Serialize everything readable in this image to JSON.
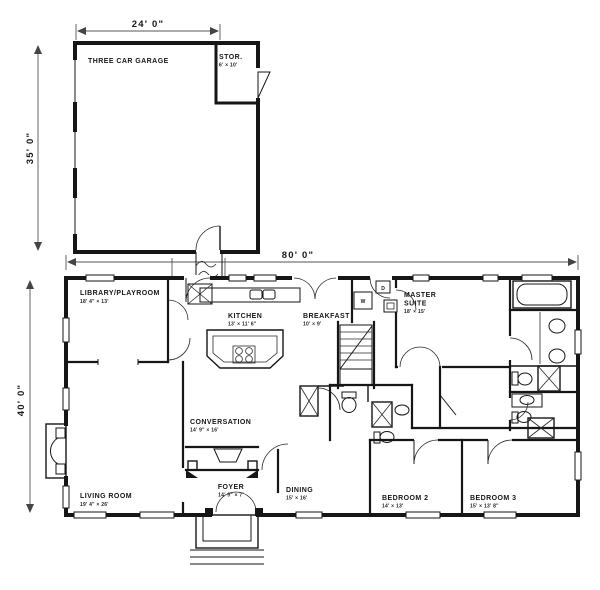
{
  "plan": {
    "dims": {
      "garage_width": "24' 0\"",
      "garage_depth": "35' 0\"",
      "house_width": "80' 0\"",
      "house_depth": "40' 0\""
    },
    "rooms": {
      "garage": {
        "label": "THREE CAR GARAGE"
      },
      "storage": {
        "label": "STOR.",
        "size": "6' × 10'"
      },
      "library": {
        "label": "LIBRARY/PLAYROOM",
        "size": "18' 4\" × 13'"
      },
      "kitchen": {
        "label": "KITCHEN",
        "size": "13' × 11' 6\""
      },
      "breakfast": {
        "label": "BREAKFAST",
        "size": "10' × 9'"
      },
      "master": {
        "label_line1": "MASTER",
        "label_line2": "SUITE",
        "size": "18' × 15'"
      },
      "conversation": {
        "label": "CONVERSATION",
        "size": "14' 9\" × 16'"
      },
      "living": {
        "label": "LIVING ROOM",
        "size": "19' 4\" × 26'"
      },
      "foyer": {
        "label": "FOYER",
        "size": "14' 9\" × 7'"
      },
      "dining": {
        "label": "DINING",
        "size": "15' × 16'"
      },
      "bedroom2": {
        "label": "BEDROOM 2",
        "size": "14' × 13'"
      },
      "bedroom3": {
        "label": "BEDROOM 3",
        "size": "15' × 13' 8\""
      }
    },
    "appliances": {
      "washer": "W",
      "dryer": "D"
    },
    "colors": {
      "ink": "#161616",
      "paper": "#ffffff"
    }
  }
}
